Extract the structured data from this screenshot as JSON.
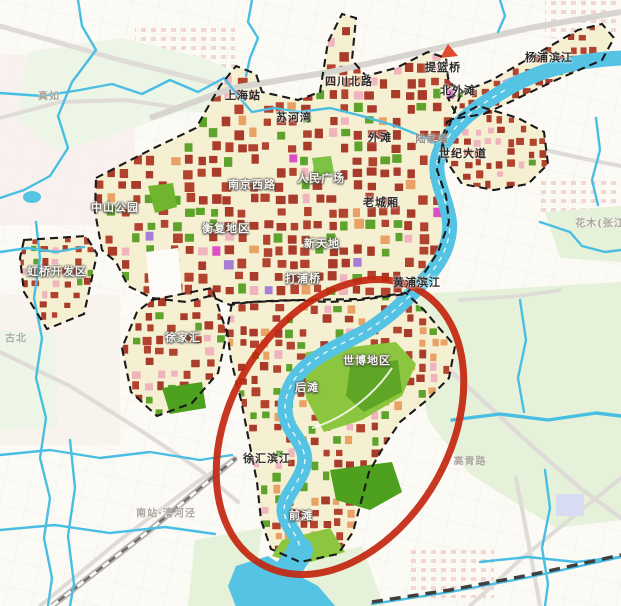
{
  "map": {
    "description": "urban planning land-use map with riverside highlight",
    "colors": {
      "water": "#55C3E4",
      "canal": "#49BEE3",
      "planning_area_fill": "#F6F0D2",
      "block_red": "#A93B2B",
      "block_red_alt": "#B2442F",
      "block_green": "#5EA32B",
      "park_green": "#8CC63F",
      "park_green_dark": "#4EA01F",
      "block_pink": "#F0B4BE",
      "block_orange": "#E9A266",
      "block_magenta": "#DD4FC4",
      "block_purple": "#A77FD6",
      "boundary_dash": "#1A1A1A",
      "road_gray": "#DFDCD8",
      "highlight_ellipse": "#C3260F"
    }
  },
  "annotation": {
    "shape": "ellipse",
    "color": "#C3260F",
    "encircles": [
      "世博地区",
      "后滩",
      "徐汇滨江",
      "前滩"
    ]
  },
  "labels": [
    {
      "text": "真如"
    },
    {
      "text": "上海站"
    },
    {
      "text": "苏河湾"
    },
    {
      "text": "四川北路"
    },
    {
      "text": "提篮桥"
    },
    {
      "text": "北外滩"
    },
    {
      "text": "杨浦滨江"
    },
    {
      "text": "外滩"
    },
    {
      "text": "陆家嘴"
    },
    {
      "text": "世纪大道"
    },
    {
      "text": "南京西路"
    },
    {
      "text": "人民广场"
    },
    {
      "text": "老城厢"
    },
    {
      "text": "中山公园"
    },
    {
      "text": "衡复地区"
    },
    {
      "text": "新天地"
    },
    {
      "text": "虹桥开发区"
    },
    {
      "text": "打浦桥"
    },
    {
      "text": "黄浦滨江"
    },
    {
      "text": "徐家汇"
    },
    {
      "text": "古北"
    },
    {
      "text": "世博地区"
    },
    {
      "text": "后滩"
    },
    {
      "text": "徐汇滨江"
    },
    {
      "text": "前滩"
    },
    {
      "text": "南站·漕河泾"
    },
    {
      "text": "高青路"
    },
    {
      "text": "花木(张江"
    }
  ]
}
